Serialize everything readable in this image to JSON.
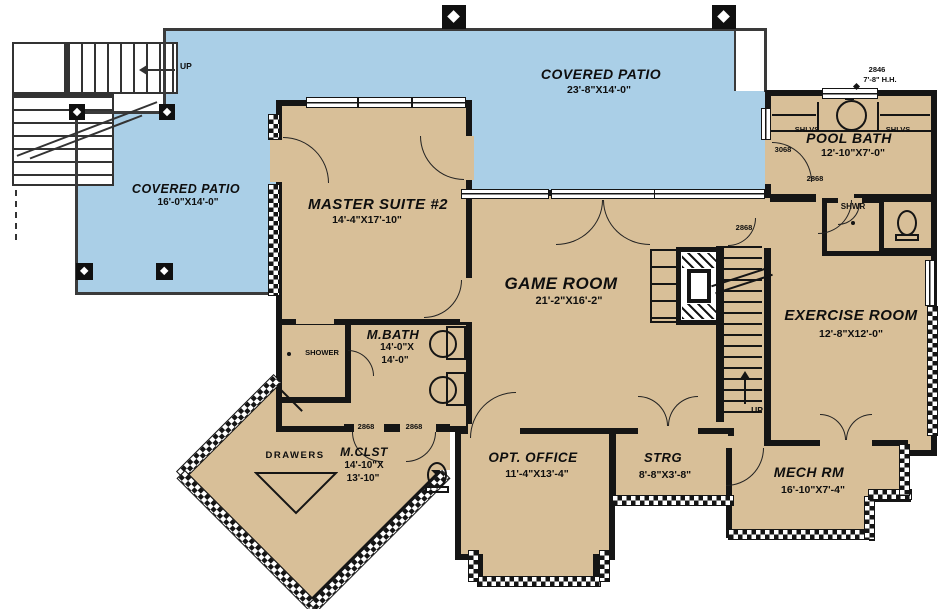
{
  "plan": {
    "rooms": {
      "covered_patio_top": {
        "name": "COVERED PATIO",
        "dims": "23'-8\"X14'-0\""
      },
      "covered_patio_left": {
        "name": "COVERED PATIO",
        "dims": "16'-0\"X14'-0\""
      },
      "master_suite": {
        "name": "MASTER SUITE #2",
        "dims": "14'-4\"X17'-10\""
      },
      "game_room": {
        "name": "GAME ROOM",
        "dims": "21'-2\"X16'-2\""
      },
      "pool_bath": {
        "name": "POOL BATH",
        "dims": "12'-10\"X7'-0\""
      },
      "exercise_room": {
        "name": "EXERCISE ROOM",
        "dims": "12'-8\"X12'-0\""
      },
      "master_bath": {
        "name": "M.BATH",
        "dims_line1": "14'-0\"X",
        "dims_line2": "14'-0\""
      },
      "master_closet": {
        "name": "M.CLST",
        "dims_line1": "14'-10\"X",
        "dims_line2": "13'-10\""
      },
      "opt_office": {
        "name": "OPT. OFFICE",
        "dims": "11'-4\"X13'-4\""
      },
      "storage": {
        "name": "STRG",
        "dims": "8'-8\"X3'-8\""
      },
      "mech_room": {
        "name": "MECH RM",
        "dims": "16'-10\"X7'-4\""
      }
    },
    "labels": {
      "shower": "SHOWER",
      "shwr": "SHWR",
      "drawers": "DRAWERS",
      "shlvs": "SHLVS",
      "up": "UP"
    },
    "openings": {
      "door_2868": "2868",
      "door_3068": "3068",
      "window_2846": "2846",
      "window_head_height": "7'-8\" H.H."
    },
    "colors": {
      "patio": "#aacfe7",
      "floor": "#d8bf98",
      "wall": "#151515"
    }
  }
}
